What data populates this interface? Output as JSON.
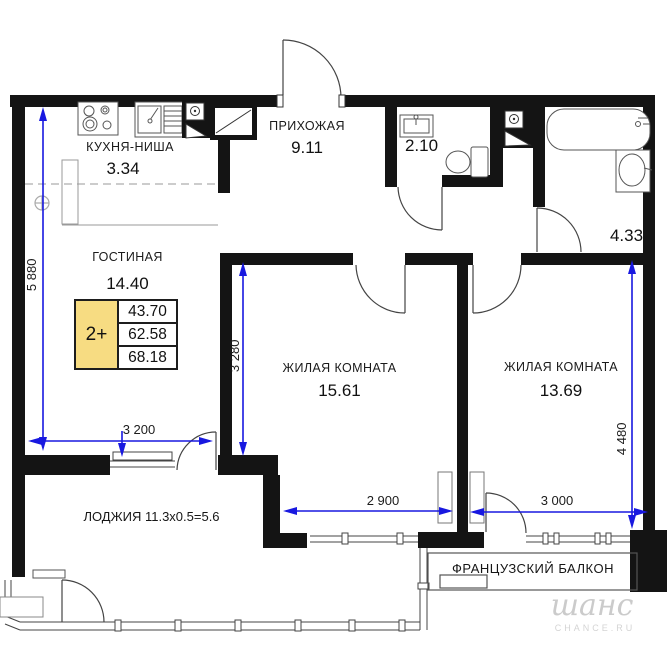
{
  "rooms": {
    "kitchen": {
      "name": "КУХНЯ-НИША",
      "area": "3.34"
    },
    "hallway": {
      "name": "ПРИХОЖАЯ",
      "area": "9.11"
    },
    "wc": {
      "area": "2.10"
    },
    "bathroom": {
      "area": "4.33"
    },
    "living": {
      "name": "ГОСТИНАЯ",
      "area": "14.40"
    },
    "bedroom1": {
      "name": "ЖИЛАЯ КОМНАТА",
      "area": "15.61"
    },
    "bedroom2": {
      "name": "ЖИЛАЯ КОМНАТА",
      "area": "13.69"
    }
  },
  "loggia_label": "ЛОДЖИЯ 11.3x0.5=5.6",
  "french_balcony_label": "ФРАНЦУЗСКИЙ БАЛКОН",
  "area_table": {
    "type_label": "2+",
    "living_area": "43.70",
    "area_no_balcony": "62.58",
    "total_area": "68.18"
  },
  "dimensions": {
    "left_height": "5 880",
    "living_width": "3 200",
    "bedroom1_height": "3 280",
    "bedroom1_width": "2 900",
    "bedroom2_width": "3 000",
    "right_height": "4 480"
  },
  "watermark": {
    "script": "шанс",
    "caption": "CHANCE.RU"
  },
  "colors": {
    "dimension_blue": "#1818e0",
    "wall_black": "#141414",
    "table_yellow": "#f7dc82",
    "watermark_gray": "#cbcbcb"
  }
}
